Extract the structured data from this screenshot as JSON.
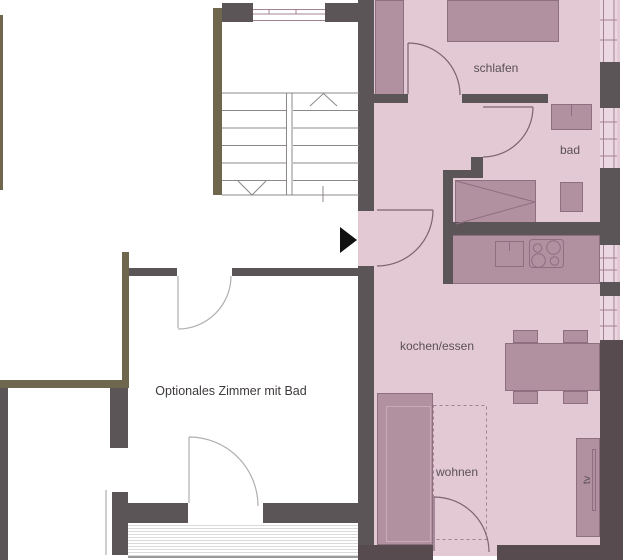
{
  "floorplan": {
    "rooms": {
      "bedroom_label": "schlafen",
      "bathroom_label": "bad",
      "kitchen_dining_label": "kochen/essen",
      "living_label": "wohnen",
      "tv_label": "tv",
      "optional_room_label": "Optionales Zimmer mit Bad"
    },
    "colors": {
      "floor": "#e3c9d4",
      "floor_window": "#ecd8e2",
      "wall_dark": "#5c5558",
      "wall_brown": "#584b4f",
      "wall_olive": "#6f674d",
      "furniture": "#b191a0",
      "furniture_border": "#8d6f7f",
      "sofa_inner": "#c6acb8",
      "door_line_pink": "#7d6470",
      "door_line_white": "#b2aeb0",
      "stair_line": "#8c888b",
      "window_frame": "#a38391",
      "label_text": "#5a5056",
      "label_strong": "#3e393c",
      "entrance_arrow": "#111111"
    }
  }
}
